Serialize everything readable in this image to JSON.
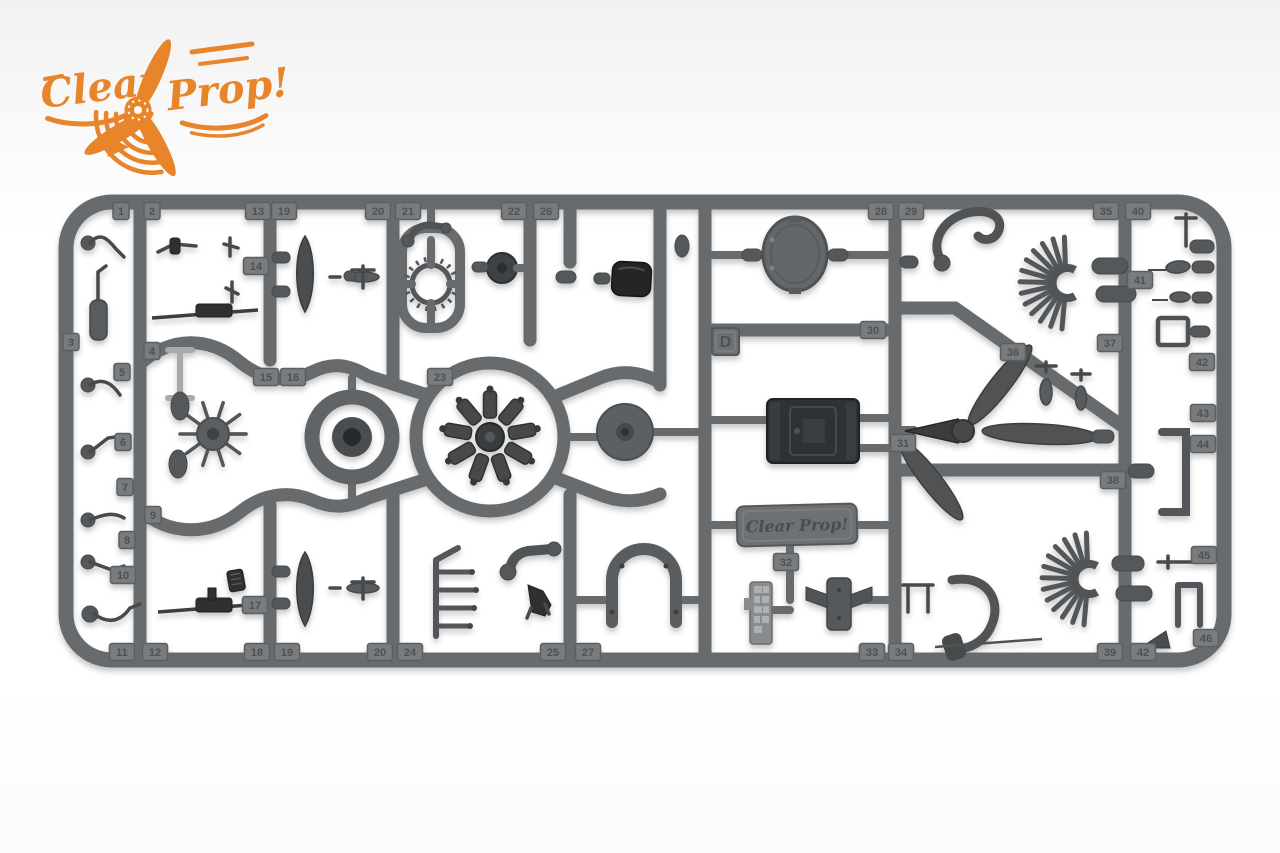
{
  "logo": {
    "word1": "Clear",
    "word2": "Prop!",
    "color": "#E8852B"
  },
  "sprue": {
    "letter": "D",
    "brand_plate_text": "Clear Prop!",
    "material_color": "#686b6d",
    "part_numbers": [
      {
        "label": "1",
        "x": 121,
        "y": 211
      },
      {
        "label": "2",
        "x": 152,
        "y": 211
      },
      {
        "label": "13",
        "x": 258,
        "y": 211
      },
      {
        "label": "19",
        "x": 284,
        "y": 211
      },
      {
        "label": "20",
        "x": 378,
        "y": 211
      },
      {
        "label": "21",
        "x": 408,
        "y": 211
      },
      {
        "label": "22",
        "x": 514,
        "y": 211
      },
      {
        "label": "26",
        "x": 546,
        "y": 211
      },
      {
        "label": "28",
        "x": 881,
        "y": 211
      },
      {
        "label": "29",
        "x": 911,
        "y": 211
      },
      {
        "label": "35",
        "x": 1106,
        "y": 211
      },
      {
        "label": "40",
        "x": 1138,
        "y": 211
      },
      {
        "label": "3",
        "x": 71,
        "y": 342
      },
      {
        "label": "5",
        "x": 122,
        "y": 372
      },
      {
        "label": "4",
        "x": 152,
        "y": 351
      },
      {
        "label": "6",
        "x": 123,
        "y": 442
      },
      {
        "label": "7",
        "x": 125,
        "y": 487
      },
      {
        "label": "9",
        "x": 153,
        "y": 515
      },
      {
        "label": "8",
        "x": 127,
        "y": 540
      },
      {
        "label": "10",
        "x": 123,
        "y": 575
      },
      {
        "label": "14",
        "x": 256,
        "y": 266
      },
      {
        "label": "17",
        "x": 255,
        "y": 605
      },
      {
        "label": "15",
        "x": 266,
        "y": 377
      },
      {
        "label": "16",
        "x": 293,
        "y": 377
      },
      {
        "label": "23",
        "x": 440,
        "y": 377
      },
      {
        "label": "30",
        "x": 873,
        "y": 330
      },
      {
        "label": "31",
        "x": 903,
        "y": 443
      },
      {
        "label": "32",
        "x": 786,
        "y": 562
      },
      {
        "label": "36",
        "x": 1013,
        "y": 352
      },
      {
        "label": "37",
        "x": 1110,
        "y": 343
      },
      {
        "label": "38",
        "x": 1113,
        "y": 480
      },
      {
        "label": "41",
        "x": 1140,
        "y": 280
      },
      {
        "label": "42",
        "x": 1202,
        "y": 362
      },
      {
        "label": "43",
        "x": 1203,
        "y": 413
      },
      {
        "label": "44",
        "x": 1203,
        "y": 444
      },
      {
        "label": "45",
        "x": 1204,
        "y": 555
      },
      {
        "label": "46",
        "x": 1206,
        "y": 638
      },
      {
        "label": "11",
        "x": 122,
        "y": 652
      },
      {
        "label": "12",
        "x": 155,
        "y": 652
      },
      {
        "label": "18",
        "x": 257,
        "y": 652
      },
      {
        "label": "19",
        "x": 287,
        "y": 652
      },
      {
        "label": "20",
        "x": 380,
        "y": 652
      },
      {
        "label": "24",
        "x": 410,
        "y": 652
      },
      {
        "label": "25",
        "x": 553,
        "y": 652
      },
      {
        "label": "27",
        "x": 588,
        "y": 652
      },
      {
        "label": "33",
        "x": 872,
        "y": 652
      },
      {
        "label": "34",
        "x": 901,
        "y": 652
      },
      {
        "label": "39",
        "x": 1110,
        "y": 652
      },
      {
        "label": "42",
        "x": 1143,
        "y": 652
      }
    ]
  }
}
